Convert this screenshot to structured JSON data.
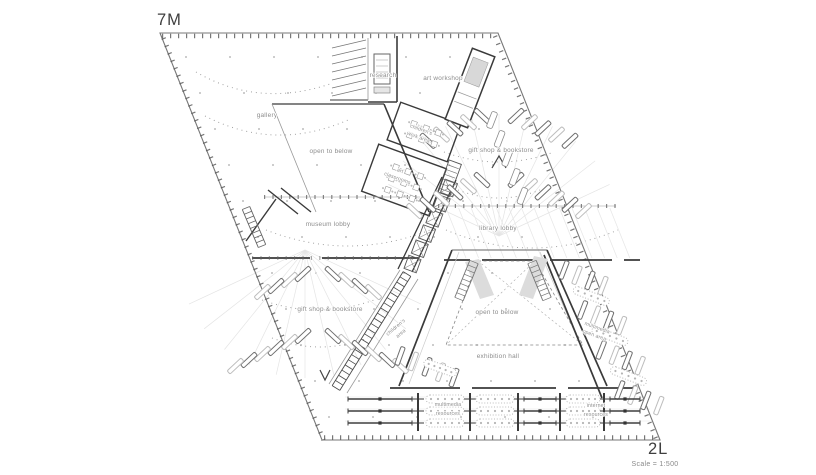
{
  "page": {
    "background": "#ffffff"
  },
  "drawing": {
    "floor_label_top_left": "7M",
    "floor_label_bottom_right": "2L",
    "scale_note": "Scale = 1:500"
  },
  "colors": {
    "ink": "#3a3a3a",
    "label": "#8c8c8c",
    "light_line": "#e0e0e0",
    "background": "#ffffff"
  },
  "rooms": {
    "research": "research",
    "art_workshop": "art workshop",
    "gallery": "gallery",
    "open_to_below_upper": "open to below",
    "childrens_work_area": {
      "line1": "children's",
      "line2": "work area"
    },
    "art_classrooms": {
      "line1": "art",
      "line2": "classrooms"
    },
    "gift_shop_bookstore_right": "gift shop & bookstore",
    "museum_lobby": "museum lobby",
    "library_lobby": "library lobby",
    "gift_shop_bookstore_left": "gift shop & bookstore",
    "childrens_area": {
      "line1": "children's",
      "line2": "area"
    },
    "open_to_below_center": "open to below",
    "exhibition_hall": "exhibition hall",
    "multimedia_open_area": {
      "line1": "multimedia",
      "line2": "open area"
    },
    "multimedia_resources": {
      "line1": "multimedia",
      "line2": "resources"
    },
    "internet_resources": {
      "line1": "internet",
      "line2": "resources"
    }
  }
}
